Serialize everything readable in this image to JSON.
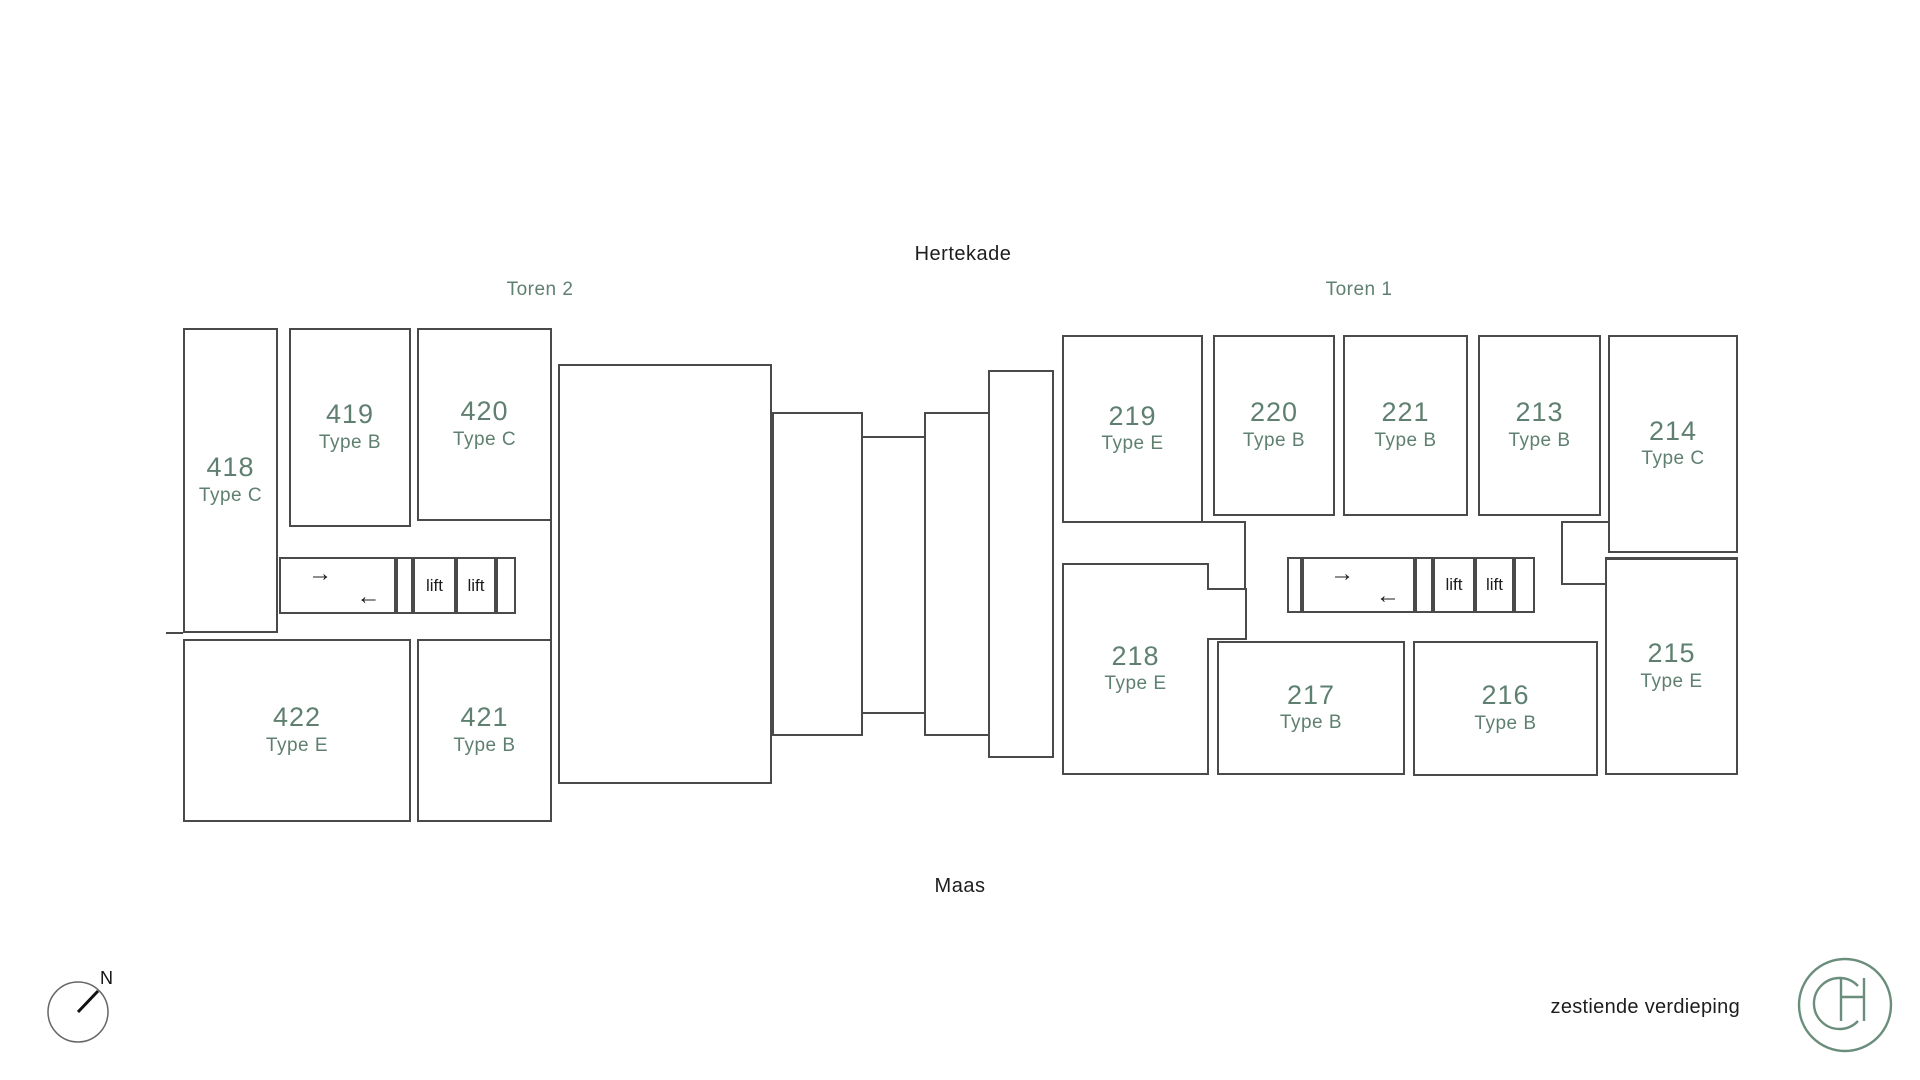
{
  "labels": {
    "street_top": "Hertekade",
    "street_bottom": "Maas",
    "floor": "zestiende verdieping",
    "compass_north": "N"
  },
  "colors": {
    "accent_green": "#5f8070",
    "wall_gray": "#4a4a4a",
    "ink": "#1d1d1d"
  },
  "towers": [
    {
      "id": "toren2",
      "label": "Toren 2",
      "units": [
        {
          "number": "418",
          "type": "Type C"
        },
        {
          "number": "419",
          "type": "Type B"
        },
        {
          "number": "420",
          "type": "Type C"
        },
        {
          "number": "422",
          "type": "Type E"
        },
        {
          "number": "421",
          "type": "Type B"
        }
      ],
      "lifts": [
        "lift",
        "lift"
      ],
      "stairs": {
        "up": "→",
        "down": "←"
      }
    },
    {
      "id": "toren1",
      "label": "Toren 1",
      "units": [
        {
          "number": "219",
          "type": "Type E"
        },
        {
          "number": "220",
          "type": "Type B"
        },
        {
          "number": "221",
          "type": "Type B"
        },
        {
          "number": "213",
          "type": "Type B"
        },
        {
          "number": "214",
          "type": "Type C"
        },
        {
          "number": "218",
          "type": "Type E"
        },
        {
          "number": "217",
          "type": "Type B"
        },
        {
          "number": "216",
          "type": "Type B"
        },
        {
          "number": "215",
          "type": "Type E"
        }
      ],
      "lifts": [
        "lift",
        "lift"
      ],
      "stairs": {
        "up": "→",
        "down": "←"
      }
    }
  ],
  "logo": {
    "monogram": "CH"
  }
}
